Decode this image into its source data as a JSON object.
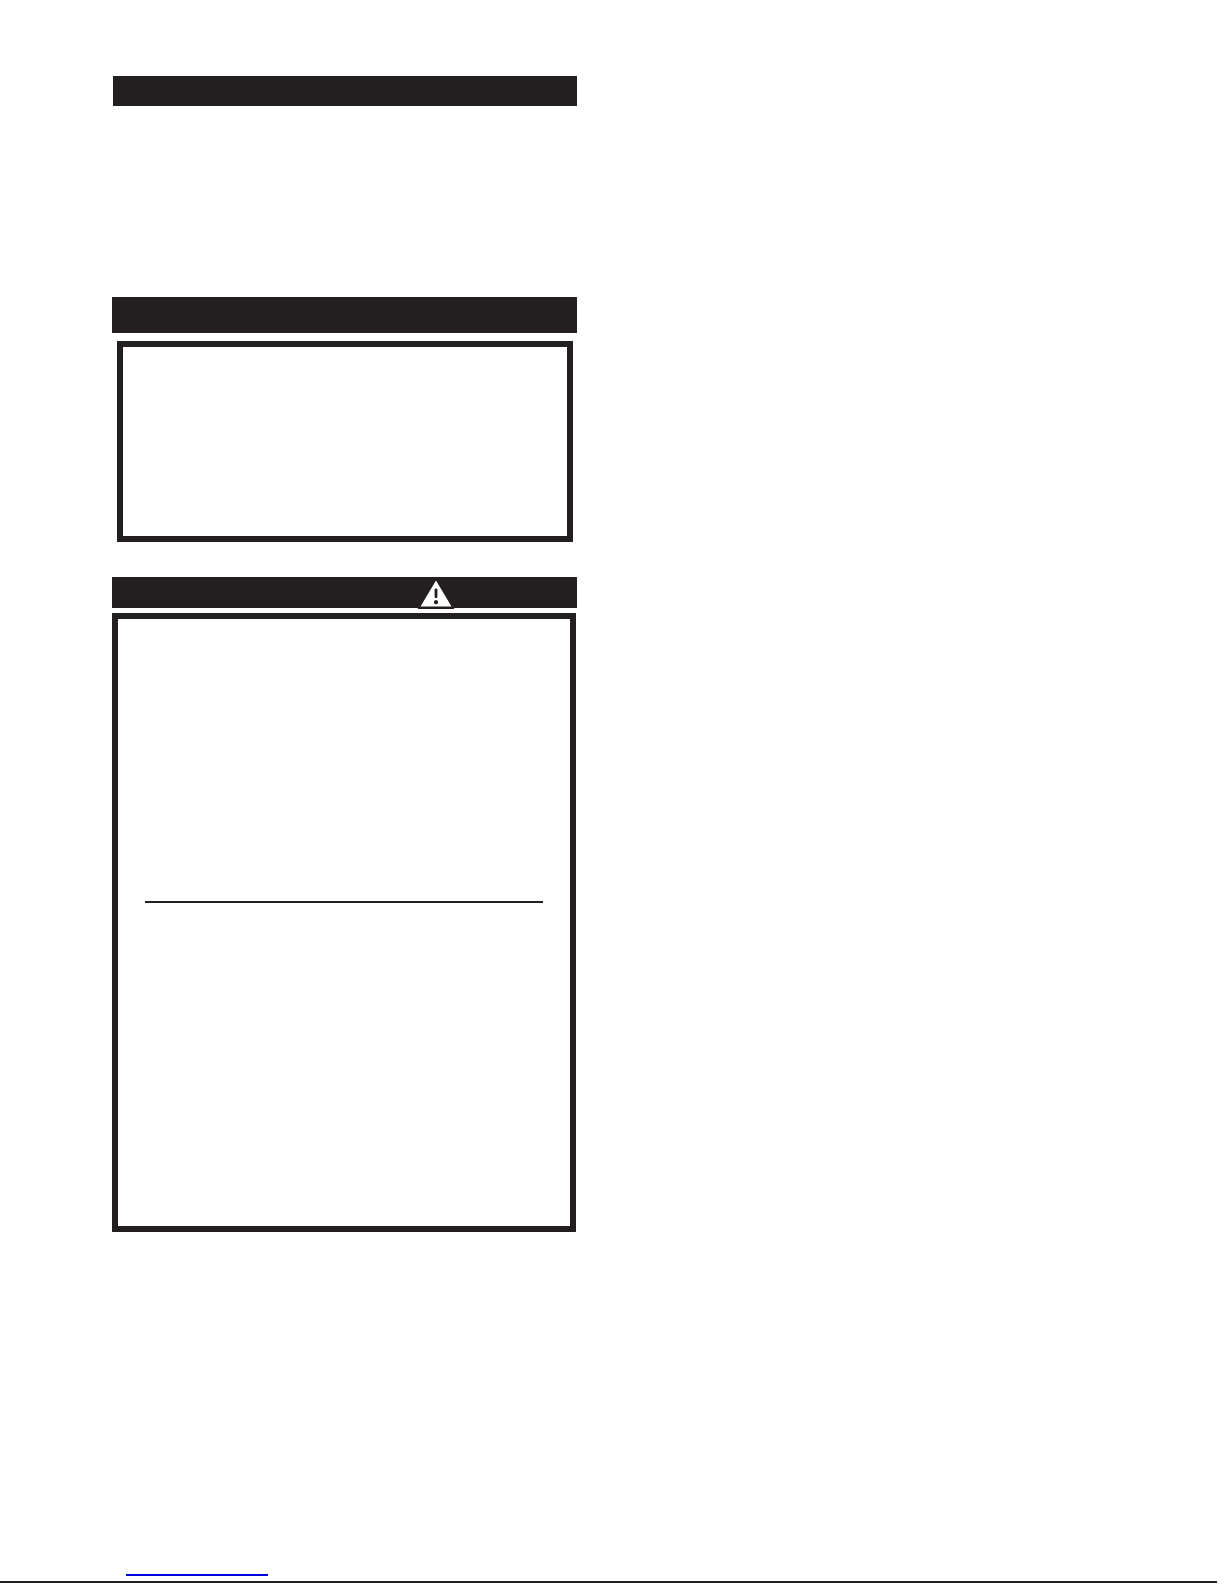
{
  "colors": {
    "paper": "#ffffff",
    "ink": "#231f20",
    "link": "#0000dd"
  },
  "header_bars": [
    {
      "label": ""
    },
    {
      "label": ""
    },
    {
      "label": ""
    }
  ],
  "warning_header": {
    "icon": "warning-triangle-icon",
    "icon_glyph": "!"
  },
  "notice_box": {
    "text": ""
  },
  "warning_box": {
    "text_above_divider": "",
    "text_below_divider": ""
  },
  "footer": {
    "link_text": ""
  }
}
